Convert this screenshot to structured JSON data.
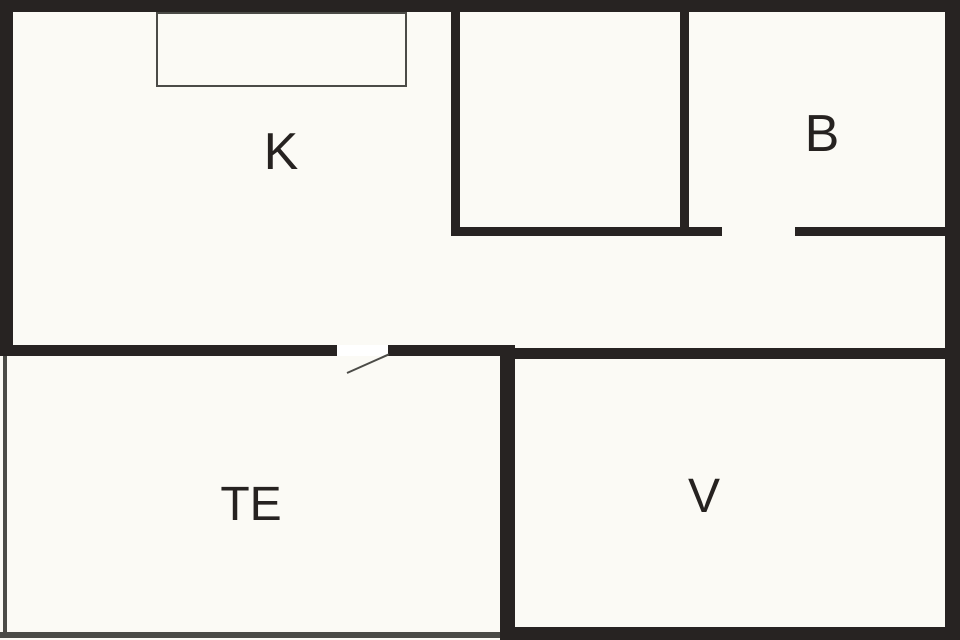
{
  "title": "Floor plan",
  "rooms": [
    {
      "id": "k",
      "label": "K"
    },
    {
      "id": "b",
      "label": "B"
    },
    {
      "id": "te",
      "label": "TE"
    },
    {
      "id": "v",
      "label": "V"
    }
  ],
  "colors": {
    "background": "#fbfaf5",
    "wall": "#272322",
    "thin_line": "#4b4b47",
    "label_text": "#262220"
  }
}
